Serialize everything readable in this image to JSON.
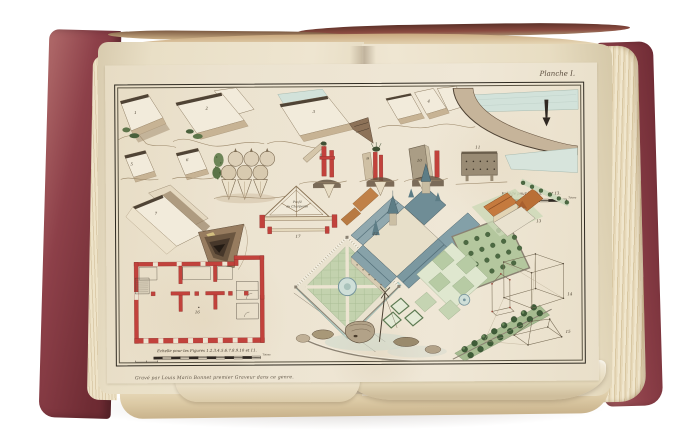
{
  "scene": {
    "description": "Photograph of an antique folio book lying open on a white background, showing a hand-coloured engraved plate (Planche I) with terrain sections, a roof truss profile, a red building floor plan, a bird's-eye view of a chateau with formal gardens, and perspective wireframe diagrams",
    "background_color": "#ffffff"
  },
  "book": {
    "cover_color": "#8d4049",
    "page_color": "#e9dfc6",
    "plate_paper_color": "#ece4d1"
  },
  "plate": {
    "title": "Planche I.",
    "caption": "Gravé par Louis Marin Bonnet premier Graveur dans ce genre.",
    "truss": {
      "line1": "Profil",
      "line2": "de Charpente"
    },
    "scales": {
      "left_label": "Echelle pour les Figures 1.2.3.4.5.6.7.8.9.10 et 11.",
      "right_label": "Echelle pour les Fig. 12 et 13.",
      "unit": "Toises"
    },
    "figure_numbers": {
      "f1": "1",
      "f2": "2",
      "f3": "3",
      "f4": "4",
      "f5": "5",
      "f6": "6",
      "f7": "7",
      "f8": "8",
      "f9": "9",
      "f10": "10",
      "f11": "11",
      "f12": "12",
      "f13": "13",
      "f14": "14",
      "f15": "15",
      "f16": "16",
      "f17": "17"
    }
  },
  "artwork_colors": {
    "plan_red": "#bf4a42",
    "roof_slate": "#7b98a0",
    "garden_green": "#b4c79e",
    "water_blue": "#cfdfd8",
    "terrain_tan": "#c7b394",
    "ink": "#2f2a21"
  }
}
